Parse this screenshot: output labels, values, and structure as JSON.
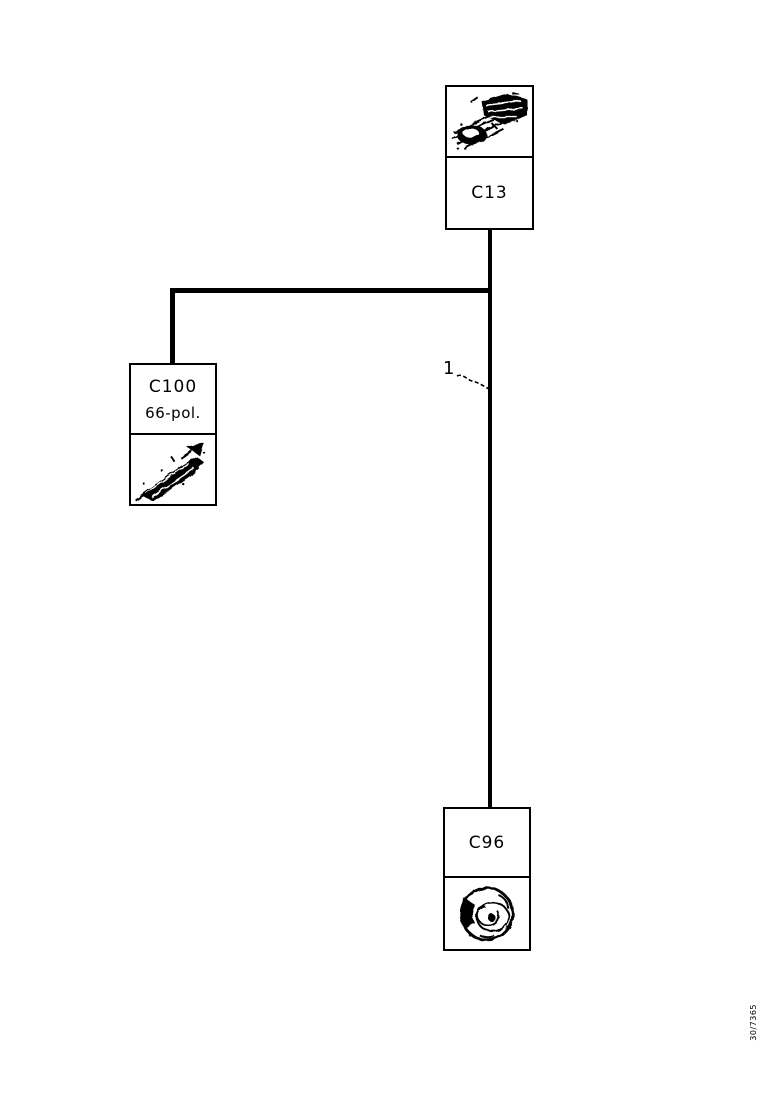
{
  "canvas": {
    "background_color": "#ffffff",
    "ink_color": "#000000"
  },
  "connectors": {
    "c13": {
      "label": "C13",
      "icon": "harness-connector-sketch"
    },
    "c100": {
      "label": "C100",
      "pins": "66-pol.",
      "icon": "harness-connector-sketch"
    },
    "c96": {
      "label": "C96",
      "icon": "round-connector-sketch"
    }
  },
  "wire": {
    "number_label": "1"
  },
  "footer": {
    "drawing_number": "30/7365"
  }
}
